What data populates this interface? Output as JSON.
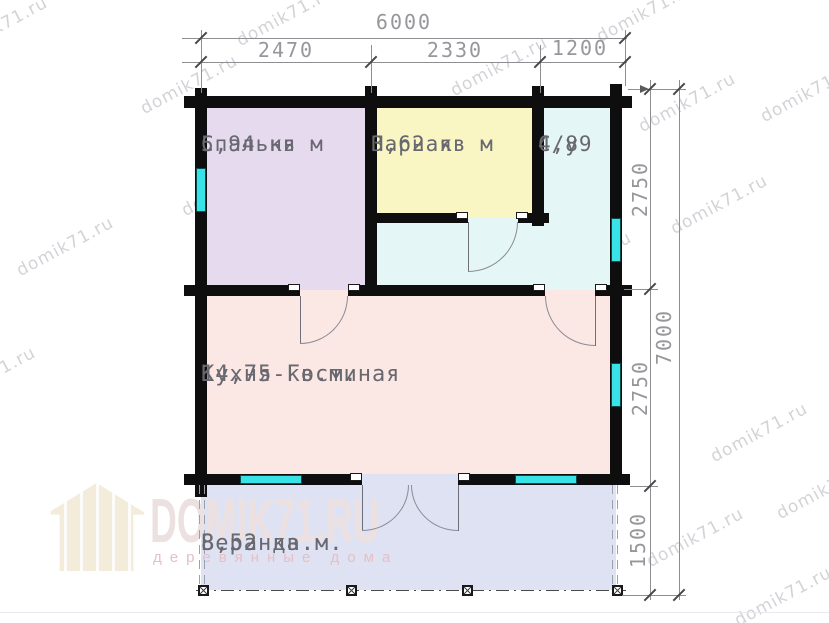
{
  "watermark": {
    "text": "domik71.ru"
  },
  "logo": {
    "title": "DOMIK71.RU",
    "subtitle": "деревянные дома"
  },
  "plan": {
    "wall_color": "#0e0e0e",
    "window_color": "#38e2e6",
    "rooms": [
      {
        "id": "bedroom",
        "name": "Спальня",
        "area": "5,94 кв м",
        "color": "#e6dbee"
      },
      {
        "id": "steam-room",
        "name": "Парная",
        "area": "3,62 кв м",
        "color": "#f9f6c4"
      },
      {
        "id": "bathroom",
        "name": "С/у",
        "area": "4,89",
        "color": "#e4f7f6"
      },
      {
        "id": "kitchen-living",
        "name": "Кухня-Гостиная",
        "area": "14,75 кв.м.",
        "color": "#fbe7e3"
      },
      {
        "id": "veranda",
        "name": "Веранда",
        "area": "8,52 кв.м.",
        "color": "#dfe2f3"
      }
    ],
    "dimensions": {
      "top": {
        "total": "6000",
        "segments": [
          "2470",
          "2330",
          "1200"
        ]
      },
      "right": {
        "total": "7000",
        "segments": [
          "2750",
          "2750",
          "1500"
        ]
      }
    }
  }
}
